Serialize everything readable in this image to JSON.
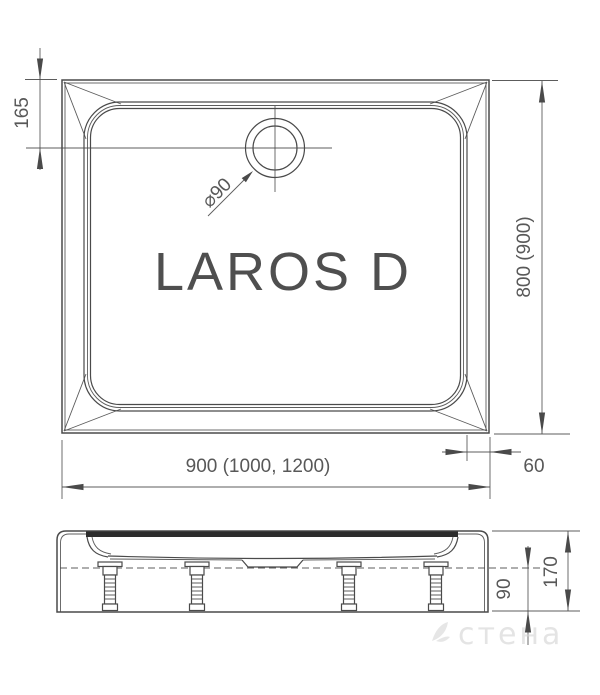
{
  "product": {
    "name": "LAROS D"
  },
  "top_view": {
    "dim_drain_offset": "165",
    "dim_depth": "800 (900)",
    "dim_width": "900 (1000, 1200)",
    "dim_rim": "60",
    "drain_label": "⌀90"
  },
  "side_view": {
    "dim_skirt_height": "90",
    "dim_total_height": "170"
  },
  "watermark": {
    "text": "стена"
  },
  "colors": {
    "line": "#4a4a4a",
    "dark": "#2c2c2c",
    "text": "#585858",
    "watermark": "#d6d6d6",
    "background": "#ffffff"
  }
}
